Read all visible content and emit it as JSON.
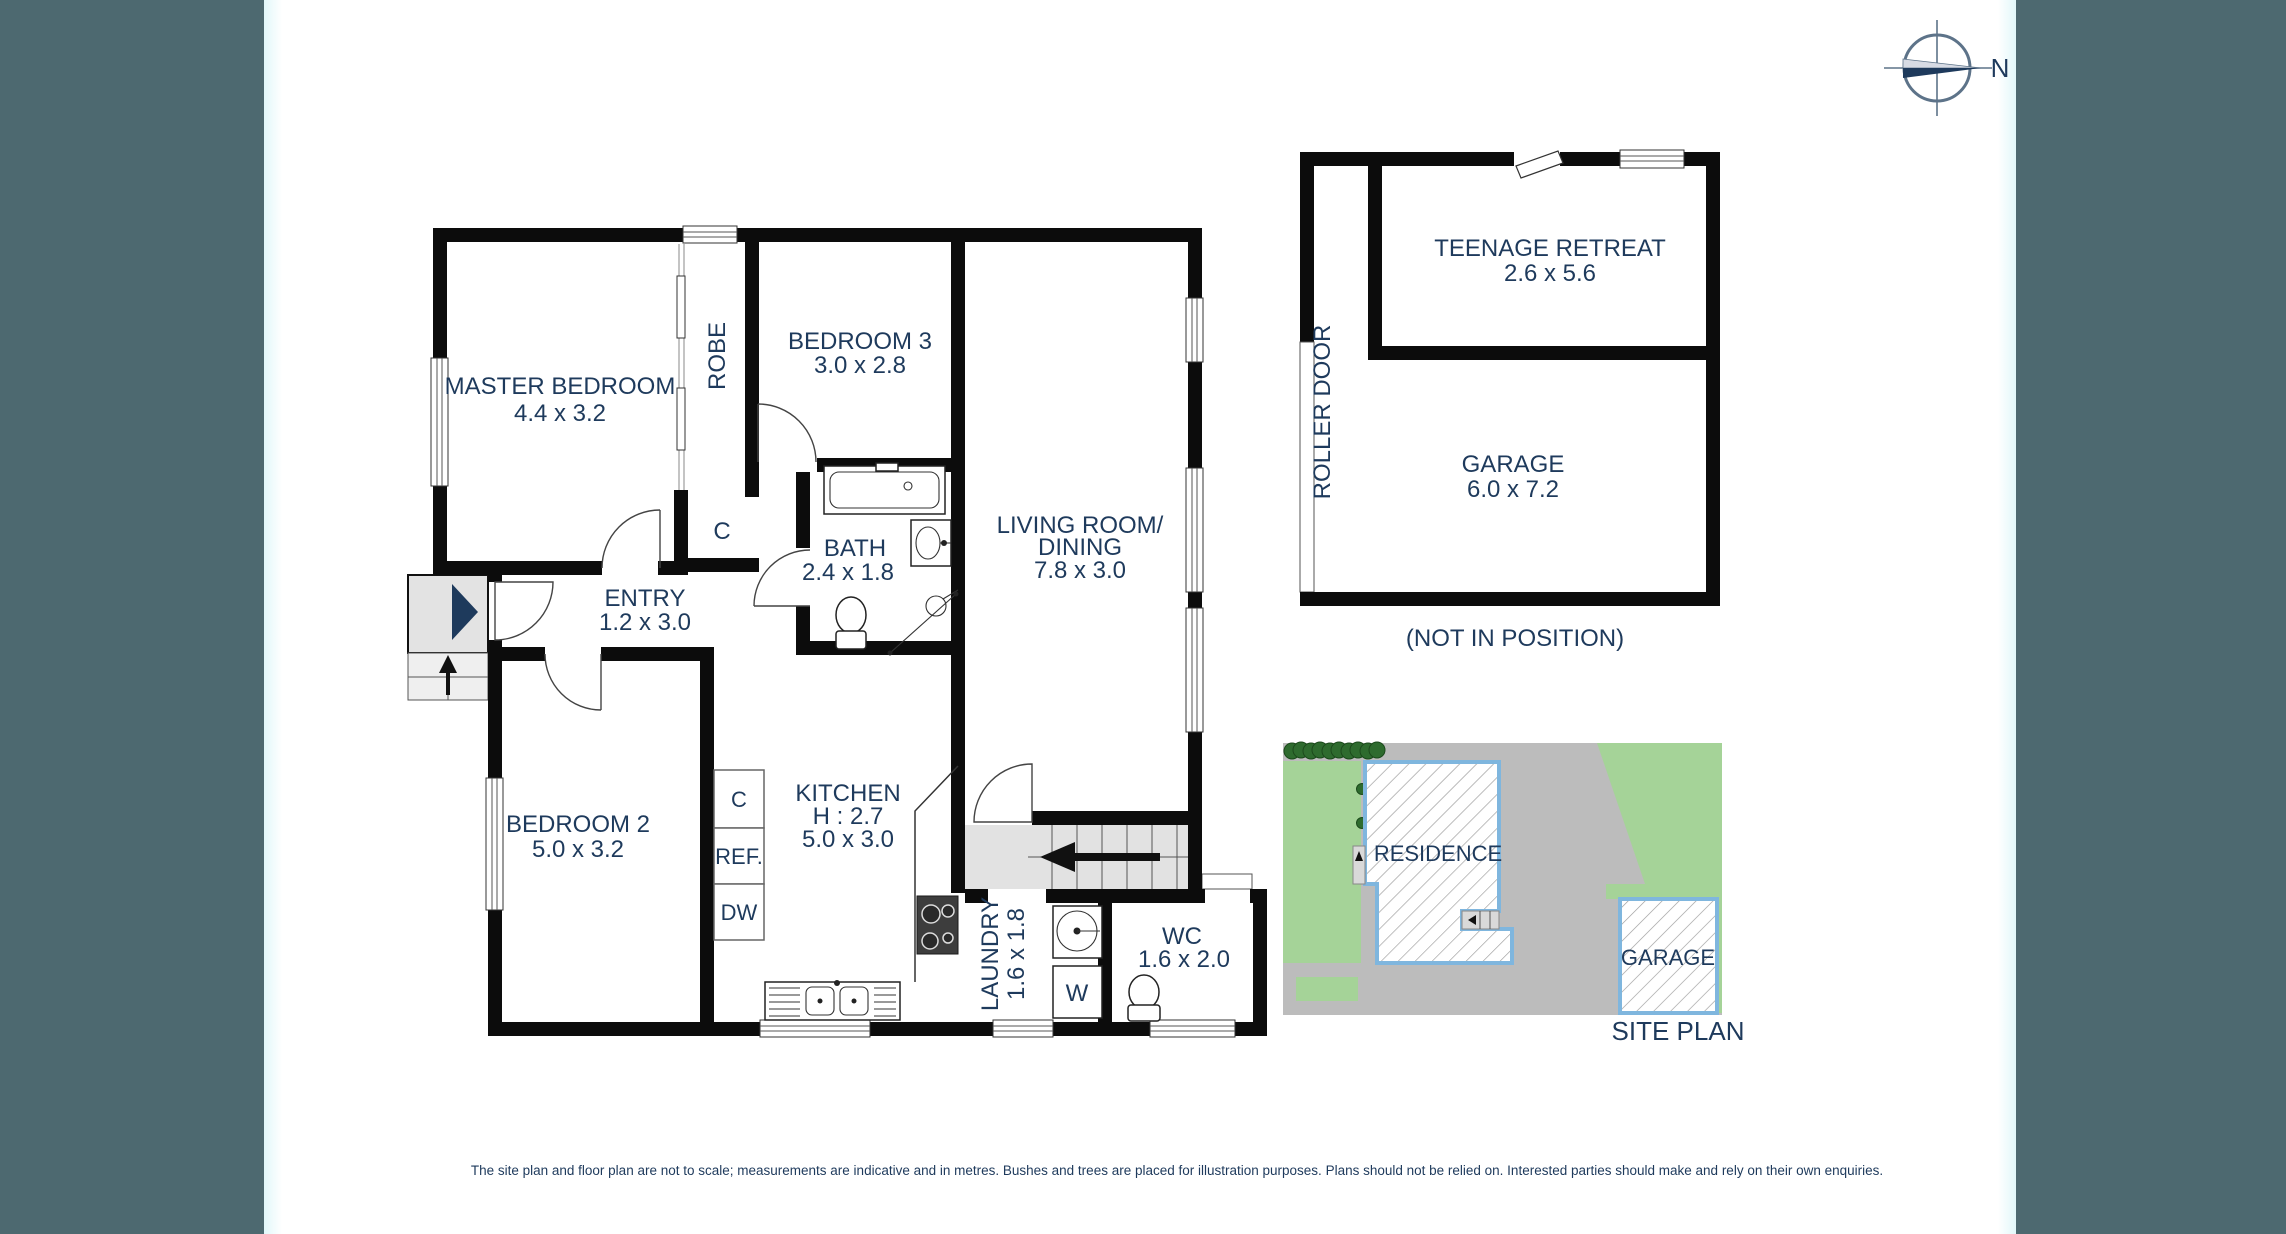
{
  "compass": {
    "north": "N"
  },
  "floor_plan": {
    "rooms": {
      "master_bedroom": {
        "name": "MASTER BEDROOM",
        "dims": "4.4 x 3.2"
      },
      "robe": {
        "name": "ROBE"
      },
      "bedroom3": {
        "name": "BEDROOM 3",
        "dims": "3.0 x 2.8"
      },
      "hall_cupboard": {
        "name": "C"
      },
      "bath": {
        "name": "BATH",
        "dims": "2.4 x 1.8"
      },
      "entry": {
        "name": "ENTRY",
        "dims": "1.2 x 3.0"
      },
      "living": {
        "name_line1": "LIVING ROOM/",
        "name_line2": "DINING",
        "dims": "7.8 x 3.0"
      },
      "bedroom2": {
        "name": "BEDROOM 2",
        "dims": "5.0 x 3.2"
      },
      "kitchen": {
        "name": "KITCHEN",
        "height": "H : 2.7",
        "dims": "5.0 x 3.0"
      },
      "kitchen_cupboard": {
        "name": "C"
      },
      "fridge": {
        "name": "REF."
      },
      "dishwasher": {
        "name": "DW"
      },
      "laundry": {
        "name": "LAUNDRY",
        "dims": "1.6 x 1.8"
      },
      "washer": {
        "name": "W"
      },
      "wc": {
        "name": "WC",
        "dims": "1.6 x 2.0"
      }
    }
  },
  "outbuilding": {
    "teenage_retreat": {
      "name": "TEENAGE RETREAT",
      "dims": "2.6 x 5.6"
    },
    "garage": {
      "name": "GARAGE",
      "dims": "6.0 x 7.2"
    },
    "roller_door": "ROLLER DOOR",
    "position_note": "(NOT IN POSITION)"
  },
  "site_plan": {
    "residence_label": "RESIDENCE",
    "garage_label": "GARAGE",
    "title": "SITE PLAN"
  },
  "disclaimer": "The site plan and floor plan are not to scale; measurements are indicative and in metres. Bushes and trees are placed for illustration purposes. Plans should not be relied on. Interested parties should make and rely on their own enquiries.",
  "colors": {
    "sidebar": "#4d6970",
    "wall": "#0c0c0c",
    "label_text": "#1e3a5c",
    "site_grass": "#a5d398",
    "site_ground": "#bcbcbc",
    "building_outline_blue": "#7fb6de",
    "tree_green": "#2e6b2e"
  }
}
